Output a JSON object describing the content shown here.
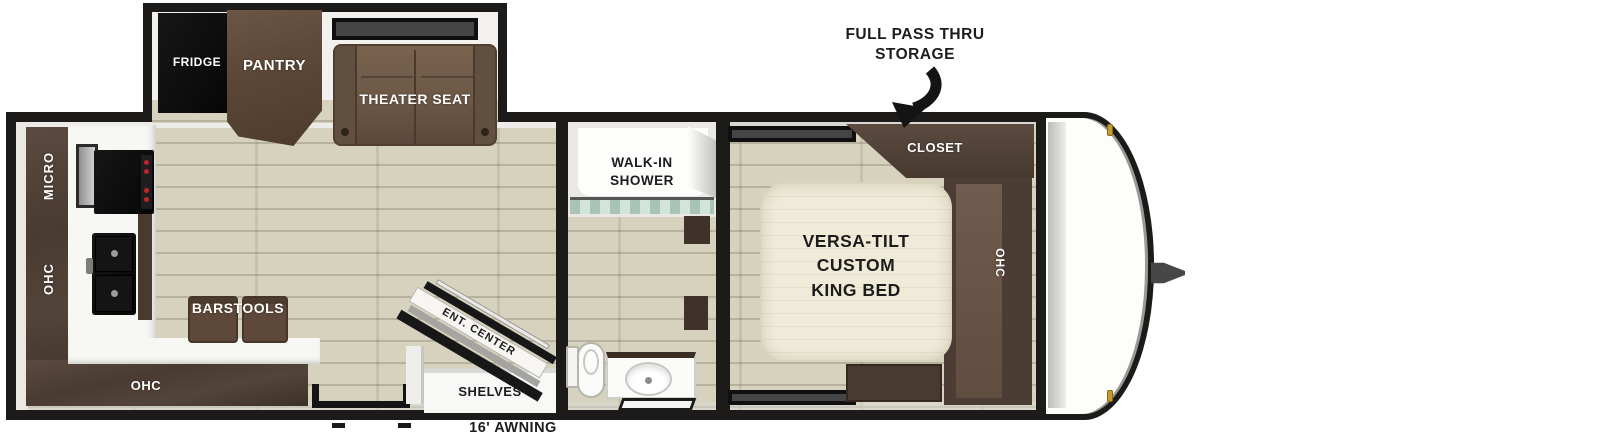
{
  "diagram": {
    "type": "rv-travel-trailer-floorplan",
    "callout": {
      "line1": "FULL PASS THRU",
      "line2": "STORAGE"
    },
    "awning_label": "16' AWNING",
    "slideout": {
      "fridge": "FRIDGE",
      "pantry": "PANTRY",
      "theater_seat": "THEATER SEAT"
    },
    "kitchen": {
      "micro": "MICRO",
      "ohc_left": "OHC",
      "ohc_bottom": "OHC",
      "barstools": "BARSTOOLS"
    },
    "living": {
      "ent_center": "ENT. CENTER",
      "shelves": "SHELVES"
    },
    "bathroom": {
      "walk_in_line1": "WALK-IN",
      "walk_in_line2": "SHOWER"
    },
    "bedroom": {
      "bed_line1": "VERSA-TILT",
      "bed_line2": "CUSTOM",
      "bed_line3": "KING BED",
      "closet": "CLOSET",
      "ohc": "OHC"
    },
    "colors": {
      "wall": "#1d1b1a",
      "floor": "#d6d2bd",
      "cabinet_dark": "#4e4037",
      "cabinet_mid": "#5e4a3c",
      "seat_brown": "#6e5949",
      "bed_cream": "#f0ebd9",
      "marker_light_gold": "#c79a2e",
      "glass_teal": "#bcd6c9",
      "label_black": "#1c1c1c"
    }
  }
}
